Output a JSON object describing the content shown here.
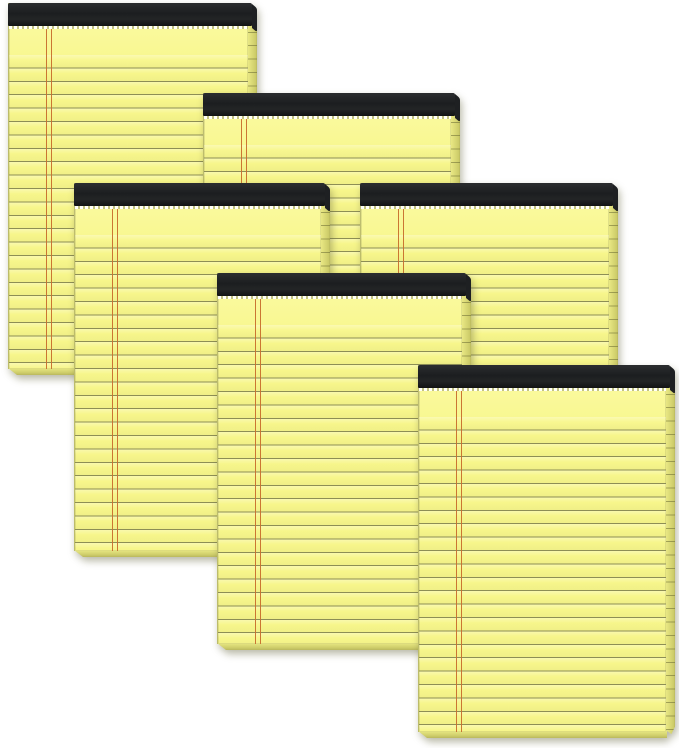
{
  "scene": {
    "alt_text": "Six canary yellow ruled legal note pads with black binding tape at the top, overlapping each other on a white background",
    "item_count": 6,
    "item_type": "yellow-legal-pad"
  },
  "colors": {
    "background": "#ffffff",
    "paper": "#f7f68b",
    "paper_light": "#fcfba6",
    "rule_line": "#8d8e55",
    "margin_line": "#c9702e",
    "binding": "#1e2022",
    "binding_dark": "#121314",
    "page_edge": "#e9e884",
    "page_edge_dark": "#cdcc69",
    "shadow": "rgba(100,100,60,0.45)"
  },
  "pad_style": {
    "binding_height_px": 23,
    "rule_spacing_px": 13.4,
    "first_rule_offset_px": 52,
    "margin_line_offset_px": 37,
    "side_edge_width_px": 9
  },
  "pads": [
    {
      "id": "pad-top-left",
      "x": 8,
      "y": 3,
      "paper_width": 240,
      "height": 372,
      "z": 1
    },
    {
      "id": "pad-top-center",
      "x": 203,
      "y": 93,
      "paper_width": 248,
      "height": 372,
      "z": 2
    },
    {
      "id": "pad-middle-left",
      "x": 74,
      "y": 183,
      "paper_width": 247,
      "height": 374,
      "z": 3
    },
    {
      "id": "pad-middle-right",
      "x": 360,
      "y": 183,
      "paper_width": 249,
      "height": 372,
      "z": 4
    },
    {
      "id": "pad-center",
      "x": 217,
      "y": 273,
      "paper_width": 245,
      "height": 377,
      "z": 5
    },
    {
      "id": "pad-bottom-right",
      "x": 418,
      "y": 365,
      "paper_width": 248,
      "height": 373,
      "z": 6
    }
  ]
}
